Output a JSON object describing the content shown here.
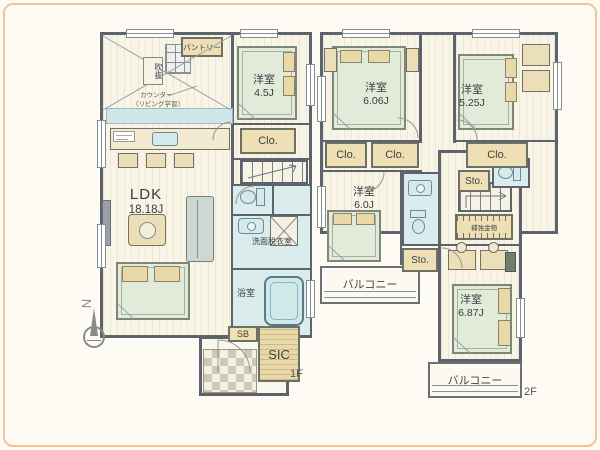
{
  "plan": {
    "compass": "N",
    "floor1": {
      "label": "1F",
      "ldk_name": "LDK",
      "ldk_size": "18.18J",
      "bedroom_name": "洋室",
      "bedroom_size": "4.5J",
      "pantry": "パントリー",
      "void_note": "吹抜",
      "counter_note1": "カウンター",
      "counter_note2": "（リビング学習）",
      "closet": "Clo.",
      "washroom": "洗面脱衣室",
      "bath": "浴室",
      "shoe_box": "SB",
      "shoe_closet": "SIC"
    },
    "floor2": {
      "label": "2F",
      "room_a_name": "洋室",
      "room_a_size": "6.06J",
      "room_b_name": "洋室",
      "room_b_size": "5.25J",
      "room_c_name": "洋室",
      "room_c_size": "6.0J",
      "room_d_name": "洋室",
      "room_d_size": "6.87J",
      "closet1": "Clo.",
      "closet2": "Clo.",
      "closet3": "Clo.",
      "storage1": "Sto.",
      "storage2": "Sto.",
      "balcony_left": "バルコニー",
      "balcony_right": "バルコニー",
      "hardware_note": "補強金物"
    },
    "colors": {
      "wall": "#5c636d",
      "floor_cream": "#f8f4e6",
      "water_blue": "#daecec",
      "furniture_tan": "#eee0b4",
      "bed_green": "#e2ead9",
      "frame_orange": "#f4c295"
    }
  }
}
